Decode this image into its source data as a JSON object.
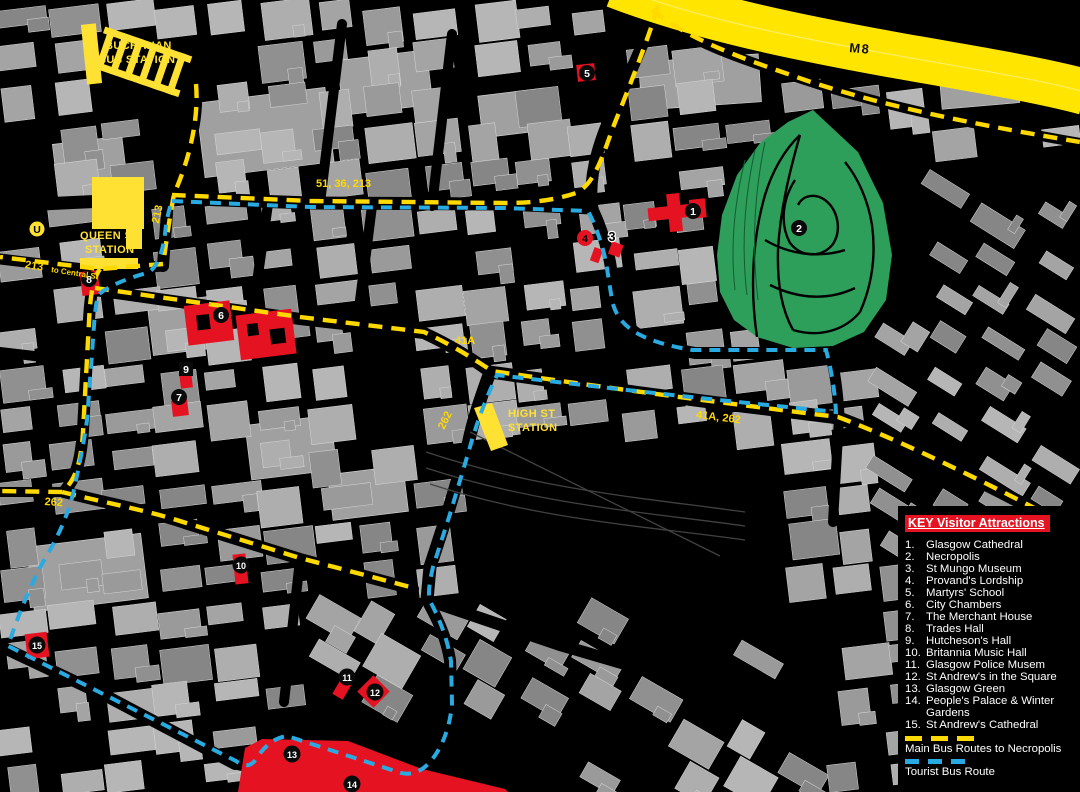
{
  "colors": {
    "yellow": "#FFD900",
    "station_yellow": "#FFE133",
    "motorway_yellow": "#FFE500",
    "tourist_blue": "#29ABE2",
    "attraction_red": "#E51321",
    "park_green": "#2E9E5B",
    "background": "#000000"
  },
  "legend": {
    "title": "KEY Visitor Attractions",
    "items": [
      {
        "n": "1.",
        "label": "Glasgow Cathedral"
      },
      {
        "n": "2.",
        "label": "Necropolis"
      },
      {
        "n": "3.",
        "label": "St Mungo Museum"
      },
      {
        "n": "4.",
        "label": "Provand's Lordship"
      },
      {
        "n": "5.",
        "label": "Martyrs' School"
      },
      {
        "n": "6.",
        "label": "City Chambers"
      },
      {
        "n": "7.",
        "label": "The Merchant House"
      },
      {
        "n": "8.",
        "label": "Trades Hall"
      },
      {
        "n": "9.",
        "label": "Hutcheson's Hall"
      },
      {
        "n": "10.",
        "label": "Britannia Music Hall"
      },
      {
        "n": "11.",
        "label": "Glasgow Police Musem"
      },
      {
        "n": "12.",
        "label": "St Andrew's in the Square"
      },
      {
        "n": "13.",
        "label": "Glasgow Green"
      },
      {
        "n": "14.",
        "label": "People's Palace & Winter Gardens"
      },
      {
        "n": "15.",
        "label": "St Andrew's Cathedral"
      }
    ],
    "main_bus_label": "Main Bus Routes to Necropolis",
    "tourist_label": "Tourist Bus Route"
  },
  "map_labels": [
    {
      "text": "M8",
      "x": 850,
      "y": 40,
      "rot": 5,
      "cls": "m8"
    },
    {
      "text": "BUCHANAN",
      "x": 105,
      "y": 40,
      "rot": 0,
      "cls": "station"
    },
    {
      "text": "BUS STATION",
      "x": 98,
      "y": 54,
      "rot": 0,
      "cls": "station"
    },
    {
      "text": "QUEEN ST",
      "x": 80,
      "y": 230,
      "rot": 0,
      "cls": "station"
    },
    {
      "text": "STATION",
      "x": 85,
      "y": 244,
      "rot": 0,
      "cls": "station"
    },
    {
      "text": "HIGH ST",
      "x": 508,
      "y": 408,
      "rot": 0,
      "cls": "station"
    },
    {
      "text": "STATION",
      "x": 508,
      "y": 422,
      "rot": 0,
      "cls": "station"
    },
    {
      "text": "51, 36, 213",
      "x": 316,
      "y": 178,
      "rot": 0,
      "cls": "route"
    },
    {
      "text": "213",
      "x": 150,
      "y": 222,
      "rot": -78,
      "cls": "route"
    },
    {
      "text": "213",
      "x": 26,
      "y": 259,
      "rot": 9,
      "cls": "route"
    },
    {
      "text": "to Central St",
      "x": 52,
      "y": 265,
      "rot": 9,
      "cls": "route-small"
    },
    {
      "text": "41A",
      "x": 455,
      "y": 335,
      "rot": 0,
      "cls": "route"
    },
    {
      "text": "262",
      "x": 436,
      "y": 426,
      "rot": -64,
      "cls": "route"
    },
    {
      "text": "41A, 262",
      "x": 697,
      "y": 409,
      "rot": 7,
      "cls": "route"
    },
    {
      "text": "262",
      "x": 45,
      "y": 496,
      "rot": 4,
      "cls": "route"
    }
  ],
  "markers": [
    {
      "n": "1",
      "x": 693,
      "y": 211,
      "style": "circle"
    },
    {
      "n": "2",
      "x": 799,
      "y": 228,
      "style": "circle"
    },
    {
      "n": "3",
      "x": 612,
      "y": 237,
      "style": "plain"
    },
    {
      "n": "4",
      "x": 585,
      "y": 238,
      "style": "red-circle"
    },
    {
      "n": "5",
      "x": 587,
      "y": 73,
      "style": "circle"
    },
    {
      "n": "6",
      "x": 221,
      "y": 315,
      "style": "circle"
    },
    {
      "n": "7",
      "x": 179,
      "y": 397,
      "style": "circle"
    },
    {
      "n": "8",
      "x": 89,
      "y": 279,
      "style": "circle"
    },
    {
      "n": "9",
      "x": 186,
      "y": 369,
      "style": "square"
    },
    {
      "n": "10",
      "x": 241,
      "y": 565,
      "style": "circle"
    },
    {
      "n": "11",
      "x": 347,
      "y": 677,
      "style": "circle"
    },
    {
      "n": "12",
      "x": 375,
      "y": 692,
      "style": "circle"
    },
    {
      "n": "13",
      "x": 292,
      "y": 754,
      "style": "circle"
    },
    {
      "n": "14",
      "x": 352,
      "y": 784,
      "style": "circle"
    },
    {
      "n": "15",
      "x": 37,
      "y": 645,
      "style": "circle"
    },
    {
      "n": "U",
      "x": 37,
      "y": 229,
      "style": "underground"
    }
  ]
}
